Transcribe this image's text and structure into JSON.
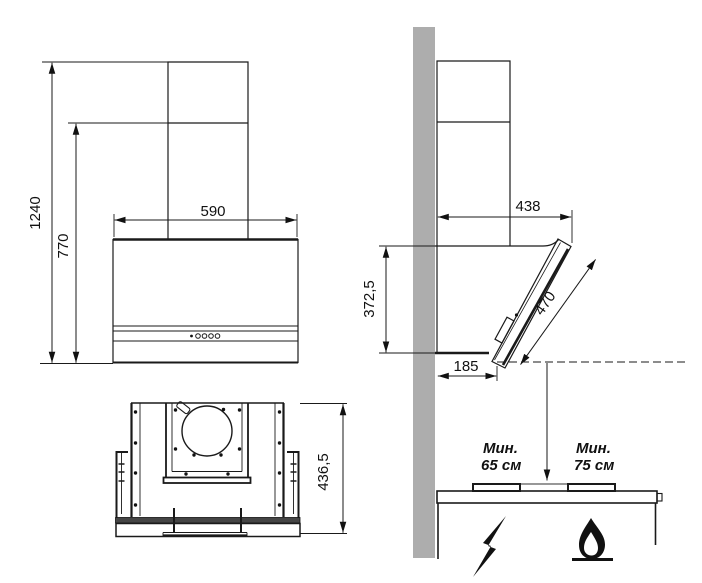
{
  "dims": {
    "front_total_height": "1240",
    "front_body_height": "770",
    "front_width": "590",
    "side_depth": "438",
    "side_body_height": "372,5",
    "side_glass_length": "470",
    "side_bottom_depth": "185",
    "top_view_depth": "436,5"
  },
  "clearance_labels": {
    "electric_line1": "Мин.",
    "electric_line2": "65 см",
    "gas_line1": "Мин.",
    "gas_line2": "75 см"
  },
  "icons": {
    "electric": "lightning-icon",
    "gas": "flame-icon"
  },
  "colors": {
    "wall": "#adadad",
    "line": "#1a1a1a",
    "glass_strip": "#454545",
    "background": "#ffffff"
  }
}
